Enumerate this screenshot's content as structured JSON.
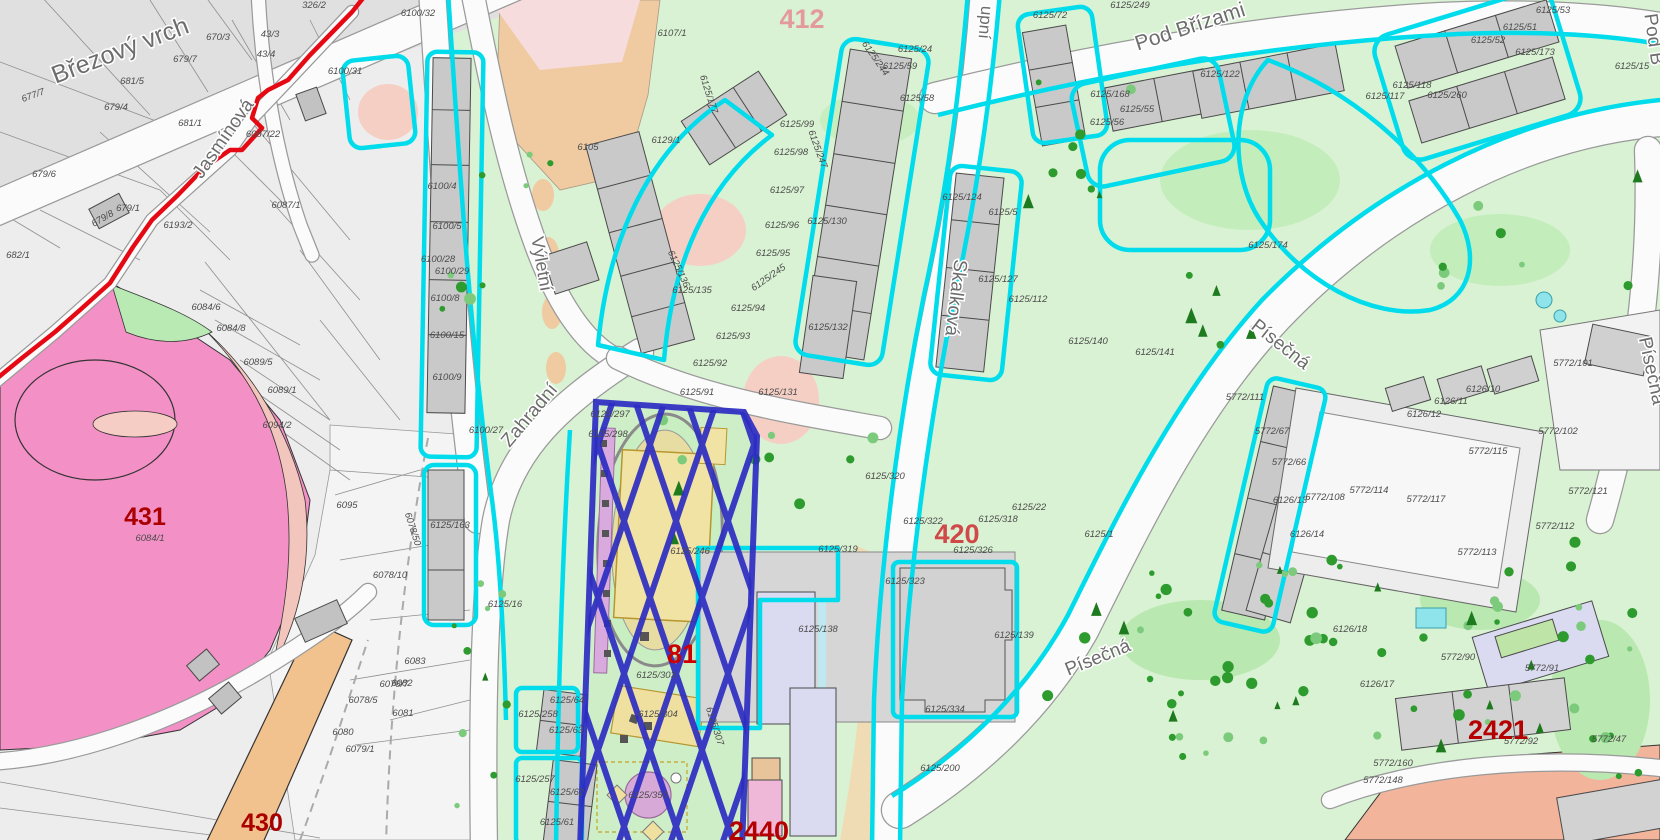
{
  "map": {
    "streets": [
      {
        "text": "Březový vrch",
        "x": 123,
        "y": 58,
        "rot": -21,
        "size": 25
      },
      {
        "text": "Jasmínová",
        "x": 228,
        "y": 142,
        "rot": -55,
        "size": 19
      },
      {
        "text": "Výletní",
        "x": 536,
        "y": 265,
        "rot": 80,
        "size": 18
      },
      {
        "text": "Zahradní",
        "x": 534,
        "y": 419,
        "rot": -50,
        "size": 19
      },
      {
        "text": "Skalková",
        "x": 950,
        "y": 297,
        "rot": 97,
        "size": 19
      },
      {
        "text": "upní",
        "x": 980,
        "y": 22,
        "rot": 95,
        "size": 17
      },
      {
        "text": "Pod Břízami",
        "x": 1192,
        "y": 33,
        "rot": -18,
        "size": 21
      },
      {
        "text": "Písečná",
        "x": 1277,
        "y": 349,
        "rot": 38,
        "size": 19
      },
      {
        "text": "Písečná",
        "x": 1100,
        "y": 663,
        "rot": -22,
        "size": 19
      },
      {
        "text": "Písečná",
        "x": 1646,
        "y": 372,
        "rot": 78,
        "size": 19
      },
      {
        "text": "Pod B",
        "x": 1648,
        "y": 40,
        "rot": 82,
        "size": 19
      }
    ],
    "area_labels": [
      {
        "text": "431",
        "x": 145,
        "y": 525,
        "color": "#aa0000",
        "size": 25
      },
      {
        "text": "430",
        "x": 262,
        "y": 831,
        "color": "#aa0000",
        "size": 25
      },
      {
        "text": "412",
        "x": 802,
        "y": 28,
        "color": "#e49a9a",
        "size": 27
      },
      {
        "text": "420",
        "x": 957,
        "y": 543,
        "color": "#d04848",
        "size": 27
      },
      {
        "text": "81",
        "x": 682,
        "y": 663,
        "color": "#cc0000",
        "size": 27
      },
      {
        "text": "2440",
        "x": 759,
        "y": 840,
        "color": "#b40000",
        "size": 27
      },
      {
        "text": "2421",
        "x": 1498,
        "y": 739,
        "color": "#b40000",
        "size": 27
      }
    ],
    "parcel_labels": [
      {
        "t": "677/7",
        "x": 34,
        "y": 98,
        "r": -20
      },
      {
        "t": "679/6",
        "x": 44,
        "y": 177
      },
      {
        "t": "679/1",
        "x": 128,
        "y": 211
      },
      {
        "t": "679/8",
        "x": 104,
        "y": 221,
        "r": -30
      },
      {
        "t": "682/1",
        "x": 18,
        "y": 258
      },
      {
        "t": "681/5",
        "x": 132,
        "y": 84
      },
      {
        "t": "679/7",
        "x": 185,
        "y": 62
      },
      {
        "t": "670/3",
        "x": 218,
        "y": 40
      },
      {
        "t": "679/4",
        "x": 116,
        "y": 110
      },
      {
        "t": "681/1",
        "x": 190,
        "y": 126
      },
      {
        "t": "6193/2",
        "x": 178,
        "y": 228
      },
      {
        "t": "326/2",
        "x": 314,
        "y": 8
      },
      {
        "t": "43/4",
        "x": 266,
        "y": 57
      },
      {
        "t": "43/3",
        "x": 270,
        "y": 37
      },
      {
        "t": "6087/1",
        "x": 286,
        "y": 208
      },
      {
        "t": "6087/22",
        "x": 263,
        "y": 137
      },
      {
        "t": "6084/6",
        "x": 206,
        "y": 310
      },
      {
        "t": "6084/8",
        "x": 231,
        "y": 331
      },
      {
        "t": "6089/5",
        "x": 258,
        "y": 365
      },
      {
        "t": "6089/1",
        "x": 282,
        "y": 393
      },
      {
        "t": "6094/2",
        "x": 277,
        "y": 428
      },
      {
        "t": "6084/1",
        "x": 150,
        "y": 541
      },
      {
        "t": "6095",
        "x": 347,
        "y": 508
      },
      {
        "t": "6078/10",
        "x": 390,
        "y": 578
      },
      {
        "t": "6078/7",
        "x": 394,
        "y": 687
      },
      {
        "t": "6078/5",
        "x": 363,
        "y": 703
      },
      {
        "t": "6081",
        "x": 403,
        "y": 716
      },
      {
        "t": "6080",
        "x": 343,
        "y": 735
      },
      {
        "t": "6082",
        "x": 402,
        "y": 686
      },
      {
        "t": "6083",
        "x": 415,
        "y": 664
      },
      {
        "t": "6079/1",
        "x": 360,
        "y": 752
      },
      {
        "t": "6078/50",
        "x": 410,
        "y": 530,
        "r": 72
      },
      {
        "t": "6100/31",
        "x": 345,
        "y": 74
      },
      {
        "t": "6100/32",
        "x": 418,
        "y": 16
      },
      {
        "t": "6100/4",
        "x": 442,
        "y": 189
      },
      {
        "t": "6100/5",
        "x": 447,
        "y": 229
      },
      {
        "t": "6100/28",
        "x": 438,
        "y": 262
      },
      {
        "t": "6100/29",
        "x": 452,
        "y": 274
      },
      {
        "t": "6100/8",
        "x": 445,
        "y": 301
      },
      {
        "t": "6100/15",
        "x": 447,
        "y": 338
      },
      {
        "t": "6100/9",
        "x": 447,
        "y": 380
      },
      {
        "t": "6100/27",
        "x": 486,
        "y": 433
      },
      {
        "t": "6105",
        "x": 588,
        "y": 150
      },
      {
        "t": "6107/1",
        "x": 672,
        "y": 36
      },
      {
        "t": "6129/1",
        "x": 666,
        "y": 143
      },
      {
        "t": "6125/177",
        "x": 706,
        "y": 95,
        "r": 72
      },
      {
        "t": "6125/135",
        "x": 692,
        "y": 293
      },
      {
        "t": "6125/136",
        "x": 676,
        "y": 270,
        "r": 65
      },
      {
        "t": "6125/95",
        "x": 773,
        "y": 256
      },
      {
        "t": "6125/94",
        "x": 748,
        "y": 311
      },
      {
        "t": "6125/93",
        "x": 733,
        "y": 339
      },
      {
        "t": "6125/92",
        "x": 710,
        "y": 366
      },
      {
        "t": "6125/91",
        "x": 697,
        "y": 395
      },
      {
        "t": "6125/99",
        "x": 797,
        "y": 127
      },
      {
        "t": "6125/98",
        "x": 791,
        "y": 155
      },
      {
        "t": "6125/97",
        "x": 787,
        "y": 193
      },
      {
        "t": "6125/96",
        "x": 782,
        "y": 228
      },
      {
        "t": "6125/247",
        "x": 815,
        "y": 150,
        "r": 70
      },
      {
        "t": "6125/244",
        "x": 873,
        "y": 60,
        "r": 55
      },
      {
        "t": "6125/24",
        "x": 915,
        "y": 52
      },
      {
        "t": "6125/59",
        "x": 900,
        "y": 69
      },
      {
        "t": "6125/58",
        "x": 917,
        "y": 101
      },
      {
        "t": "6125/130",
        "x": 827,
        "y": 224
      },
      {
        "t": "6125/132",
        "x": 828,
        "y": 330
      },
      {
        "t": "6125/131",
        "x": 778,
        "y": 395
      },
      {
        "t": "6125/245",
        "x": 770,
        "y": 280,
        "r": -35
      },
      {
        "t": "6125/249",
        "x": 1130,
        "y": 8
      },
      {
        "t": "6125/72",
        "x": 1050,
        "y": 18
      },
      {
        "t": "6125/168",
        "x": 1110,
        "y": 97
      },
      {
        "t": "6125/55",
        "x": 1137,
        "y": 112
      },
      {
        "t": "6125/56",
        "x": 1107,
        "y": 125
      },
      {
        "t": "6125/122",
        "x": 1220,
        "y": 77
      },
      {
        "t": "6125/174",
        "x": 1268,
        "y": 248
      },
      {
        "t": "6125/141",
        "x": 1155,
        "y": 355
      },
      {
        "t": "5772/111",
        "x": 1245,
        "y": 400
      },
      {
        "t": "6125/124",
        "x": 962,
        "y": 200
      },
      {
        "t": "6125/5",
        "x": 1003,
        "y": 215
      },
      {
        "t": "6125/127",
        "x": 998,
        "y": 282
      },
      {
        "t": "6125/112",
        "x": 1028,
        "y": 302
      },
      {
        "t": "6125/140",
        "x": 1088,
        "y": 344
      },
      {
        "t": "6125/320",
        "x": 885,
        "y": 479
      },
      {
        "t": "6125/322",
        "x": 923,
        "y": 524
      },
      {
        "t": "6125/319",
        "x": 838,
        "y": 552
      },
      {
        "t": "6125/318",
        "x": 998,
        "y": 522
      },
      {
        "t": "6125/22",
        "x": 1029,
        "y": 510
      },
      {
        "t": "6125/1",
        "x": 1099,
        "y": 537
      },
      {
        "t": "6125/326",
        "x": 973,
        "y": 553
      },
      {
        "t": "6125/323",
        "x": 905,
        "y": 584
      },
      {
        "t": "6125/138",
        "x": 818,
        "y": 632
      },
      {
        "t": "6125/139",
        "x": 1014,
        "y": 638
      },
      {
        "t": "6125/334",
        "x": 945,
        "y": 712
      },
      {
        "t": "6125/200",
        "x": 940,
        "y": 771
      },
      {
        "t": "6125/303",
        "x": 656,
        "y": 678
      },
      {
        "t": "6125/246",
        "x": 690,
        "y": 554
      },
      {
        "t": "6125/298",
        "x": 608,
        "y": 437
      },
      {
        "t": "6125/297",
        "x": 610,
        "y": 417
      },
      {
        "t": "6125/163",
        "x": 450,
        "y": 528
      },
      {
        "t": "6125/16",
        "x": 505,
        "y": 607
      },
      {
        "t": "6125/304",
        "x": 658,
        "y": 717
      },
      {
        "t": "6125/307",
        "x": 712,
        "y": 727,
        "r": 72
      },
      {
        "t": "6125/257",
        "x": 535,
        "y": 782
      },
      {
        "t": "6125/258",
        "x": 538,
        "y": 717
      },
      {
        "t": "6125/64",
        "x": 567,
        "y": 703
      },
      {
        "t": "6125/63",
        "x": 566,
        "y": 733
      },
      {
        "t": "6125/62",
        "x": 567,
        "y": 795
      },
      {
        "t": "6125/61",
        "x": 557,
        "y": 825
      },
      {
        "t": "6125/350",
        "x": 648,
        "y": 798
      },
      {
        "t": "5772/115",
        "x": 1488,
        "y": 454
      },
      {
        "t": "5772/117",
        "x": 1426,
        "y": 502
      },
      {
        "t": "5772/113",
        "x": 1477,
        "y": 555
      },
      {
        "t": "5772/114",
        "x": 1369,
        "y": 493
      },
      {
        "t": "5772/112",
        "x": 1555,
        "y": 529
      },
      {
        "t": "5772/101",
        "x": 1573,
        "y": 366
      },
      {
        "t": "5772/102",
        "x": 1558,
        "y": 434
      },
      {
        "t": "5772/121",
        "x": 1588,
        "y": 494
      },
      {
        "t": "6126/10",
        "x": 1483,
        "y": 392
      },
      {
        "t": "6126/11",
        "x": 1451,
        "y": 404
      },
      {
        "t": "6126/12",
        "x": 1424,
        "y": 417
      },
      {
        "t": "6126/13",
        "x": 1290,
        "y": 503
      },
      {
        "t": "6126/14",
        "x": 1307,
        "y": 537
      },
      {
        "t": "5772/108",
        "x": 1325,
        "y": 500
      },
      {
        "t": "5772/66",
        "x": 1289,
        "y": 465
      },
      {
        "t": "5772/67",
        "x": 1272,
        "y": 434
      },
      {
        "t": "6126/17",
        "x": 1377,
        "y": 687
      },
      {
        "t": "6126/18",
        "x": 1350,
        "y": 632
      },
      {
        "t": "5772/90",
        "x": 1458,
        "y": 660
      },
      {
        "t": "5772/91",
        "x": 1542,
        "y": 671
      },
      {
        "t": "5772/92",
        "x": 1521,
        "y": 744
      },
      {
        "t": "5772/47",
        "x": 1609,
        "y": 742
      },
      {
        "t": "5772/160",
        "x": 1393,
        "y": 766
      },
      {
        "t": "5772/148",
        "x": 1383,
        "y": 783
      },
      {
        "t": "6125/53",
        "x": 1553,
        "y": 13
      },
      {
        "t": "6125/51",
        "x": 1520,
        "y": 30
      },
      {
        "t": "6125/52",
        "x": 1488,
        "y": 43
      },
      {
        "t": "6125/173",
        "x": 1535,
        "y": 55
      },
      {
        "t": "6125/15",
        "x": 1632,
        "y": 69
      },
      {
        "t": "6125/260",
        "x": 1447,
        "y": 98
      },
      {
        "t": "6125/118",
        "x": 1412,
        "y": 88
      },
      {
        "t": "6125/117",
        "x": 1385,
        "y": 99
      }
    ],
    "colors": {
      "parcel_outline_cyan": "#00dcec",
      "detail_hatch_blue": "#2d2dc2",
      "boundary_red": "#e50914",
      "area_number_red": "#b00000",
      "area_pink": "#f391c6",
      "area_salmon": "#f3c6bd",
      "area_orange": "#f2c28e",
      "area_tan": "#f0caa0",
      "green_base": "#d9f2d3",
      "green_dark_tree": "#2e9b2e",
      "building_grey": "#c9c9c9",
      "building_lavender": "#dadaf0",
      "building_yellow": "#f1e3a4",
      "grey_zone": "#ededed",
      "purple_feature": "#d7a9d7",
      "pool_blue": "#8fe3ea"
    }
  }
}
